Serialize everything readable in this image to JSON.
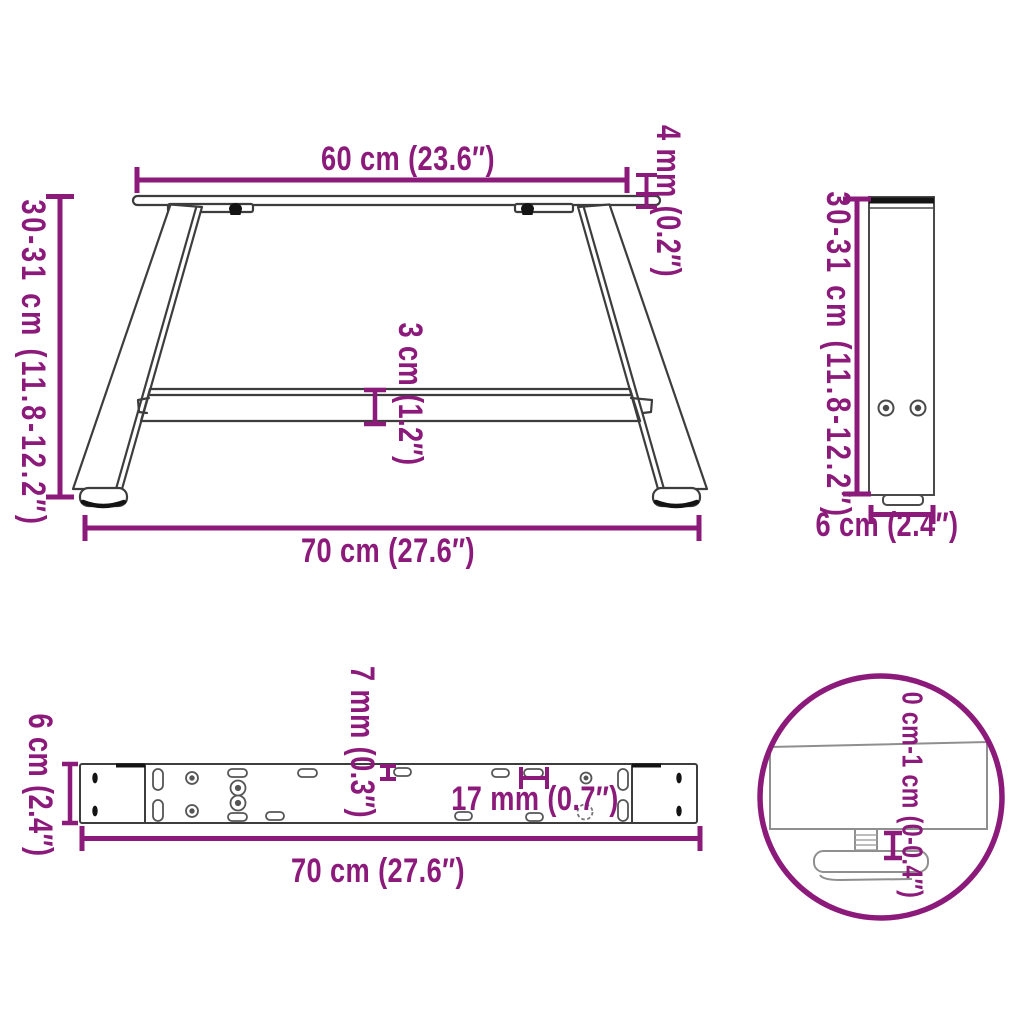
{
  "diagram_type": "product-dimension-diagram",
  "product": "A-shaped coffee table legs",
  "colors": {
    "accent": "#8C1A7B",
    "line_dark": "#3d3d3d",
    "line_medium": "#555555",
    "line_gray": "#8f8f8f",
    "fill_dark": "#141414",
    "background": "#ffffff"
  },
  "front_view": {
    "top_width": "60 cm (23.6″)",
    "top_plate_thickness": "4 mm (0.2″)",
    "height": "30-31 cm (11.8-12.2″)",
    "crossbar_thickness": "3 cm (1.2″)",
    "bottom_width": "70 cm (27.6″)"
  },
  "side_view": {
    "height": "30-31 cm (11.8-12.2″)",
    "depth": "6 cm (2.4″)"
  },
  "top_view": {
    "depth": "6 cm (2.4″)",
    "slot_width": "7 mm (0.3″)",
    "hole_width": "17 mm (0.7″)",
    "length": "70 cm (27.6″)"
  },
  "detail_view": {
    "adjustable_foot_range": "0 cm-1 cm (0-0.4″)"
  }
}
